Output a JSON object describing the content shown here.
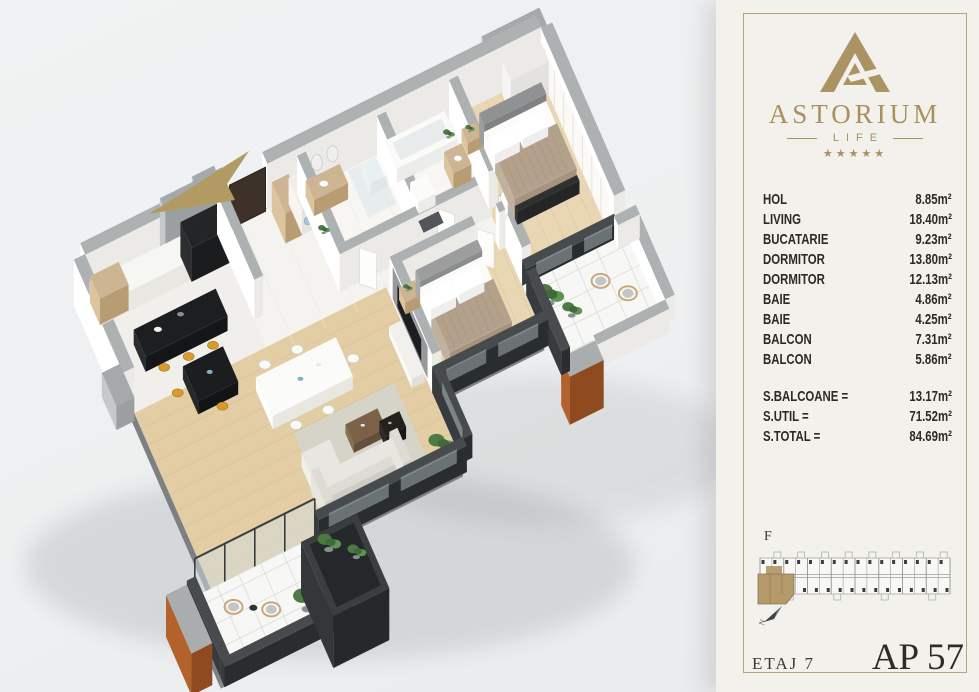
{
  "brand": {
    "name": "ASTORIUM",
    "sub": "LIFE",
    "stars": "★★★★★"
  },
  "rooms": [
    {
      "label": "HOL",
      "area": "8.85m²"
    },
    {
      "label": "LIVING",
      "area": "18.40m²"
    },
    {
      "label": "BUCATARIE",
      "area": "9.23m²"
    },
    {
      "label": "DORMITOR",
      "area": "13.80m²"
    },
    {
      "label": "DORMITOR",
      "area": "12.13m²"
    },
    {
      "label": "BAIE",
      "area": "4.86m²"
    },
    {
      "label": "BAIE",
      "area": "4.25m²"
    },
    {
      "label": "BALCON",
      "area": "7.31m²"
    },
    {
      "label": "BALCON",
      "area": "5.86m²"
    }
  ],
  "totals": [
    {
      "label": "S.BALCOANE =",
      "area": "13.17m²"
    },
    {
      "label": "S.UTIL =",
      "area": "71.52m²"
    },
    {
      "label": "S.TOTAL =",
      "area": "84.69m²"
    }
  ],
  "site": {
    "section_label": "F",
    "north_label": "N"
  },
  "footer": {
    "floor": "ETAJ 7",
    "apartment": "AP 57"
  },
  "colors": {
    "gold": "#b29a63",
    "copper": "#b4622c",
    "charcoal": "#2d3032",
    "panel_bg": "#f3f1ec",
    "border": "#b6a47c",
    "text_dark": "#2b2a28",
    "unit_highlight": "#b49a6a"
  }
}
